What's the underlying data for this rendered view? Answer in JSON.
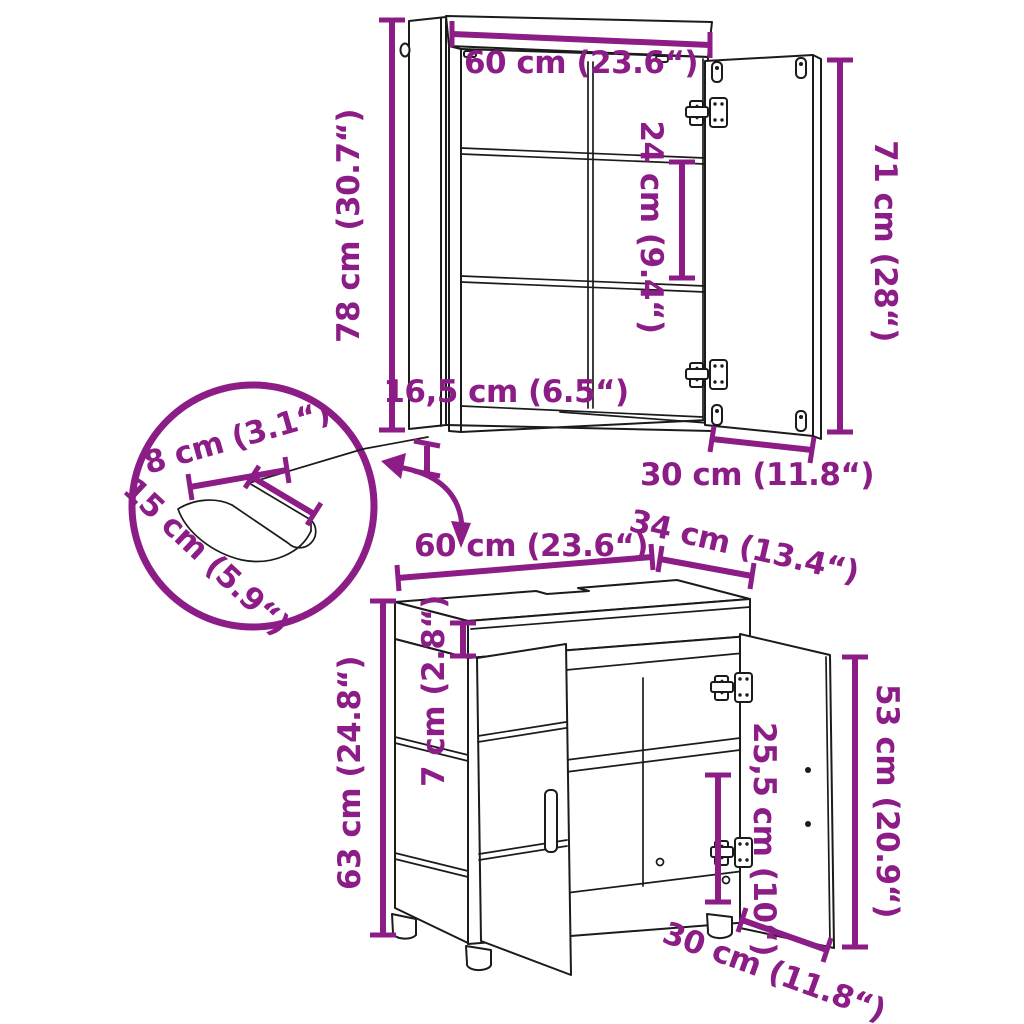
{
  "colors": {
    "dimension_purple": "#8C1C86",
    "line_black": "#1B1B1B",
    "background": "#FFFFFF"
  },
  "labels": {
    "mirror_cabinet": {
      "width": "60 cm (23.6“)",
      "height": "78 cm (30.7“)",
      "shelf_spacing": "24 cm (9.4“)",
      "door_height": "71 cm (28“)",
      "depth": "16,5 cm (6.5“)",
      "door_width": "30 cm (11.8“)"
    },
    "cutout_detail": {
      "width": "8 cm (3.1“)",
      "depth": "15 cm (5.9“)"
    },
    "sink_cabinet": {
      "width": "60 cm (23.6“)",
      "depth": "34 cm (13.4“)",
      "top_section_height": "7 cm (2.8“)",
      "height": "63 cm (24.8“)",
      "opening_height": "25,5 cm (10“)",
      "door_height": "53 cm (20.9“)",
      "door_width": "30 cm (11.8“)"
    }
  }
}
